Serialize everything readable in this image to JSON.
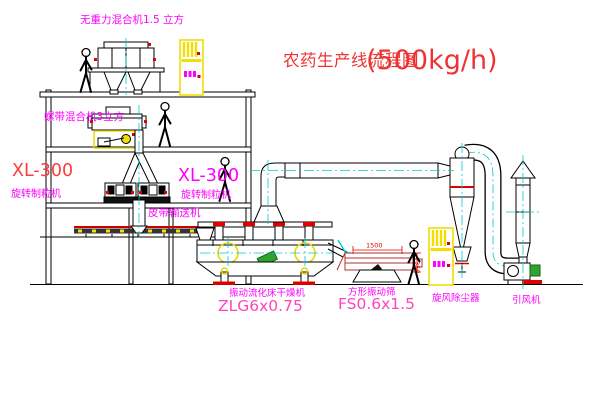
{
  "title": {
    "text": "农药生产线流程图",
    "capacity": "(500kg/h)"
  },
  "equipment": {
    "top_mixer": {
      "label": "无重力混合机1.5 立方"
    },
    "ribbon_mixer": {
      "label": "螺带混合机3立方"
    },
    "granulator_left": {
      "model": "XL-300",
      "name": "旋转制粒机"
    },
    "granulator_mid": {
      "model": "XL-300",
      "name": "旋转制粒机"
    },
    "belt_conveyor": {
      "label": "皮带输送机"
    },
    "dryer": {
      "name": "振动流化床干燥机",
      "model": "ZLG6x0.75"
    },
    "screen": {
      "name": "方形振动筛",
      "model": "FS0.6x1.5",
      "dim_width": "1500",
      "dim_height": "350"
    },
    "cyclone": {
      "label": "旋风除尘器"
    },
    "fan": {
      "label": "引风机"
    }
  },
  "colors": {
    "line": "#000000",
    "centerline": "#00cccc",
    "label_magenta": "#ff00ff",
    "model_pink": "#ff44bb",
    "title_red": "#ee3333",
    "accent_red": "#dd0000",
    "cabinet_yellow": "#f2de00",
    "motor_green": "#2fa32f"
  }
}
